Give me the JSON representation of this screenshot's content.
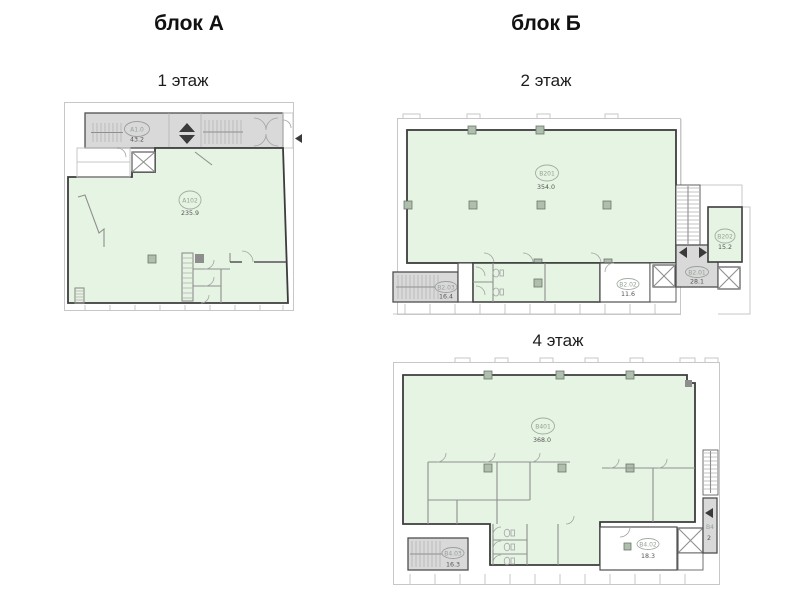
{
  "blocks": {
    "a": {
      "title": "блок А"
    },
    "b": {
      "title": "блок Б"
    }
  },
  "floors": {
    "f1": {
      "title": "1 этаж"
    },
    "f2": {
      "title": "2 этаж"
    },
    "f4": {
      "title": "4 этаж"
    }
  },
  "rooms": {
    "a10": {
      "id": "А1.0",
      "area": "43.2"
    },
    "a102": {
      "id": "А102",
      "area": "235.9"
    },
    "b201": {
      "id": "В201",
      "area": "354.0"
    },
    "b2_03": {
      "id": "В2.03",
      "area": "16.4"
    },
    "b2_02": {
      "id": "В2.02",
      "area": "11.6"
    },
    "b2_01": {
      "id": "В2.01",
      "area": "28.1"
    },
    "b202": {
      "id": "В202",
      "area": "15.2"
    },
    "b401": {
      "id": "В401",
      "area": "368.0"
    },
    "b4_03": {
      "id": "В4.03",
      "area": "16.3"
    },
    "b4_02": {
      "id": "В4.02",
      "area": "18.3"
    },
    "b4_01": {
      "id": "В4",
      "area": "2"
    }
  },
  "colors": {
    "green": "#e6f4e3",
    "gray": "#d9d9d9",
    "wall": "#3c3c3c",
    "light": "#c7c7c7",
    "label": "#94a094",
    "area": "#555555"
  }
}
